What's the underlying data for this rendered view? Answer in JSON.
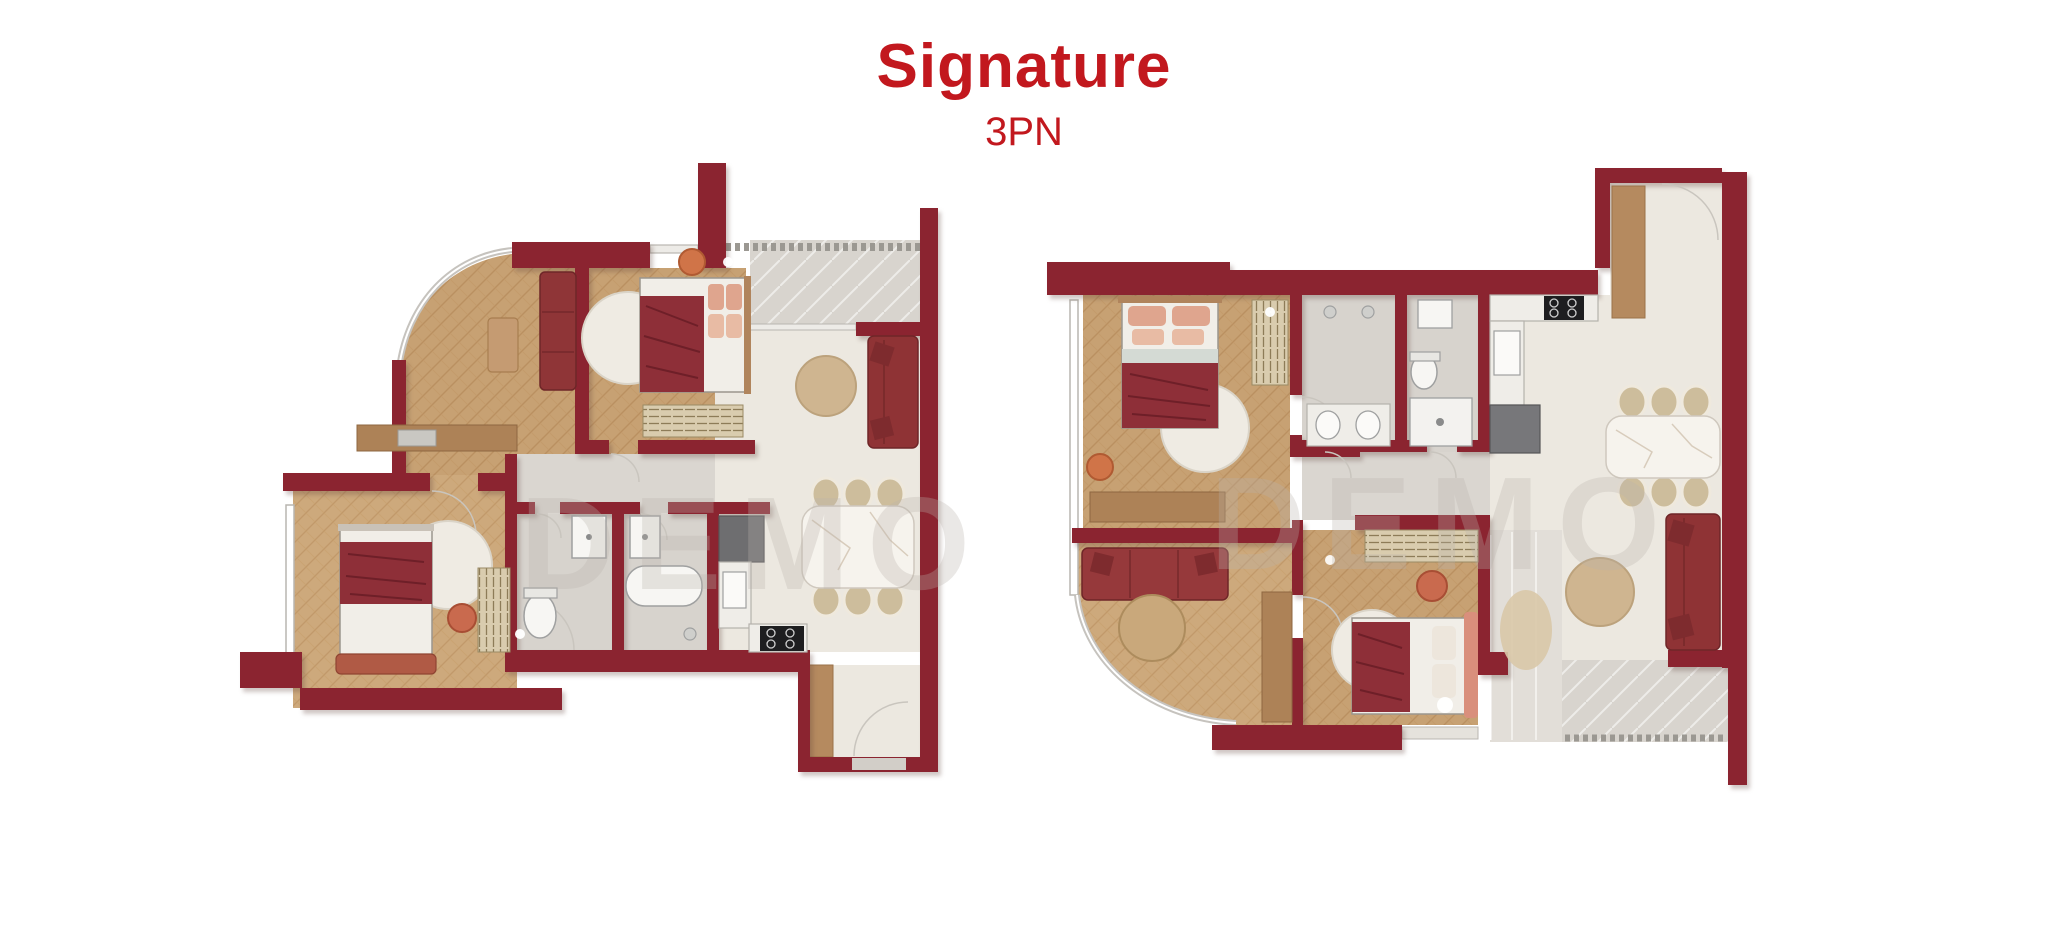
{
  "header": {
    "title": "Signature",
    "subtitle": "3PN"
  },
  "watermark": {
    "text": "DEMO"
  },
  "colors": {
    "title_red": "#C2181E",
    "wall_maroon": "#8B2430",
    "wood_floor": "#C7A173",
    "wood_floor_light": "#CDA97C",
    "tile_gray": "#D8D4CE",
    "tile_cream": "#ECE8E0",
    "furniture_red": "#8F3537",
    "bed_blanket_red": "#8E2F38",
    "pillow_salmon": "#DFA58E",
    "accent_terracotta": "#D07448",
    "rug_white": "#EFEBE3",
    "rug_tan": "#CFB590",
    "console_wood": "#AD8257",
    "marble_white": "#F6F3ED"
  }
}
